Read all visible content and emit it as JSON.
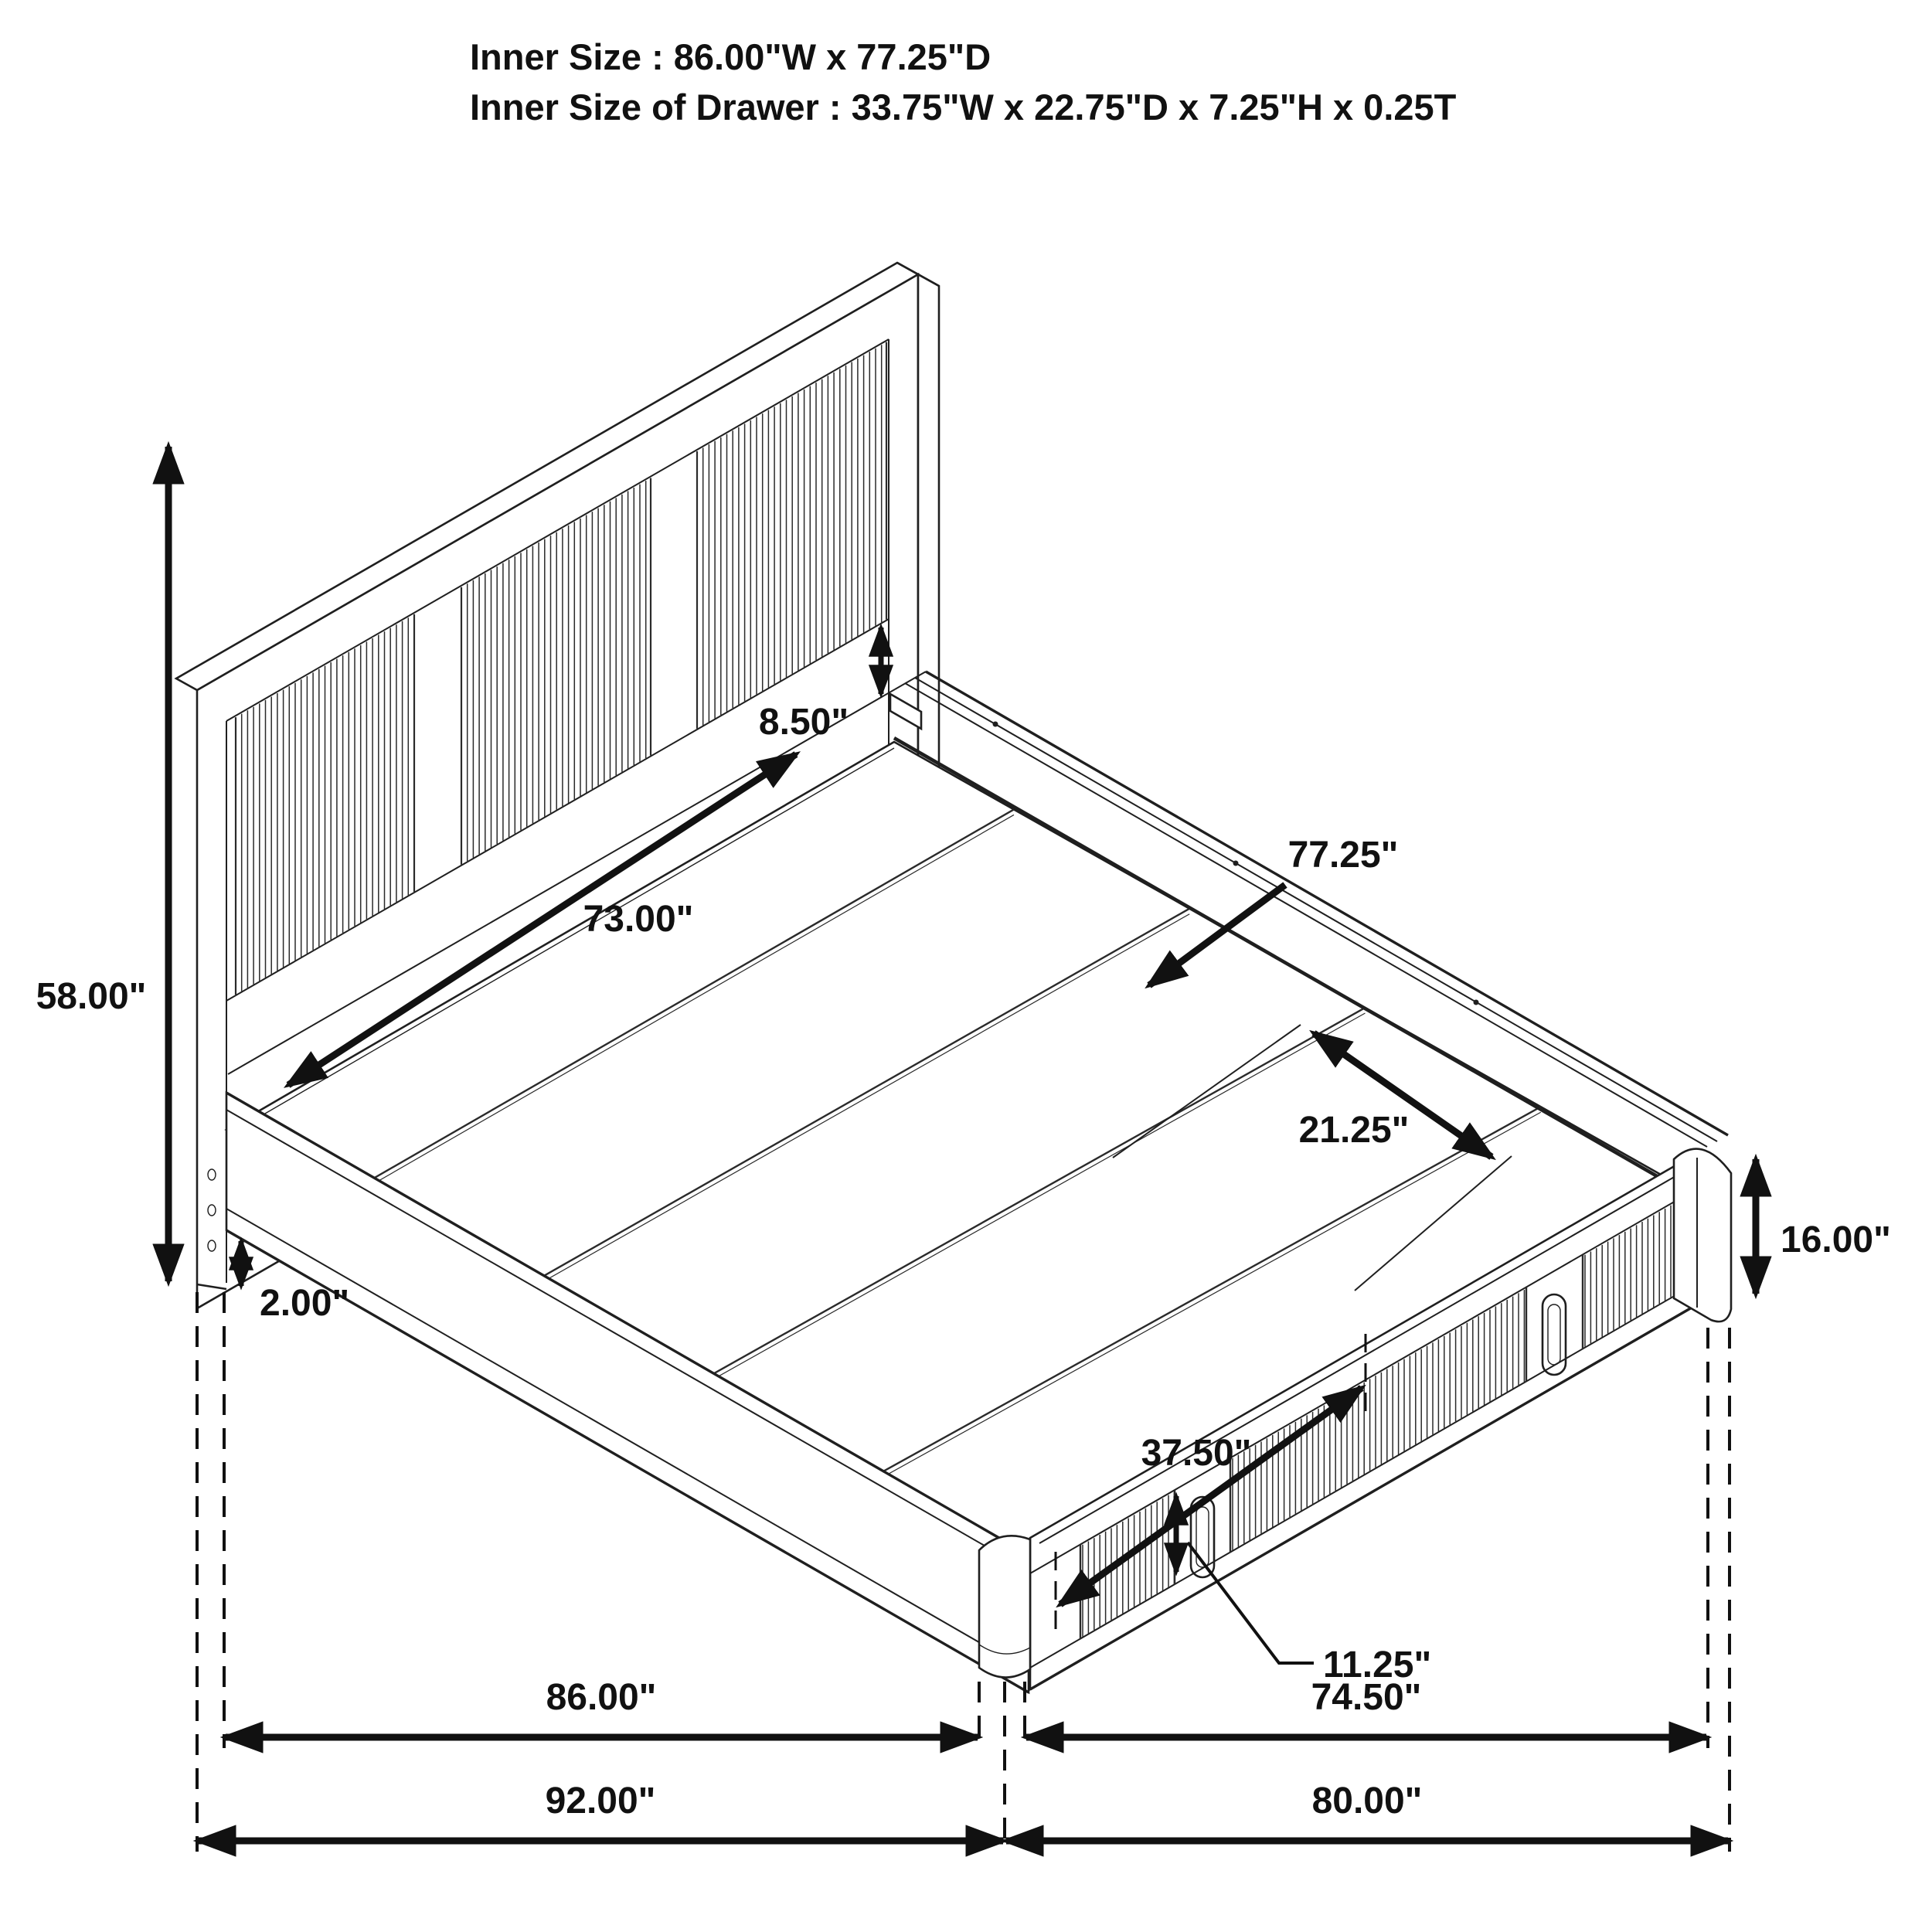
{
  "title": {
    "line1": "Inner Size : 86.00\"W x 77.25\"D",
    "line2": "Inner Size of Drawer : 33.75\"W x 22.75\"D x 7.25\"H x 0.25T"
  },
  "dimensions": {
    "headboard_height": "58.00\"",
    "floor_clearance": "2.00\"",
    "headboard_inner_width": "73.00\"",
    "headboard_rail_height": "8.50\"",
    "inner_depth": "77.25\"",
    "rail_to_drawer": "21.25\"",
    "platform_height": "16.00\"",
    "drawer_width": "37.50\"",
    "drawer_front_height": "11.25\"",
    "inner_width": "86.00\"",
    "outer_width": "92.00\"",
    "drawer_span_depth": "74.50\"",
    "outer_depth": "80.00\""
  },
  "style": {
    "line_color": "#1a1a1a",
    "background": "#ffffff"
  }
}
